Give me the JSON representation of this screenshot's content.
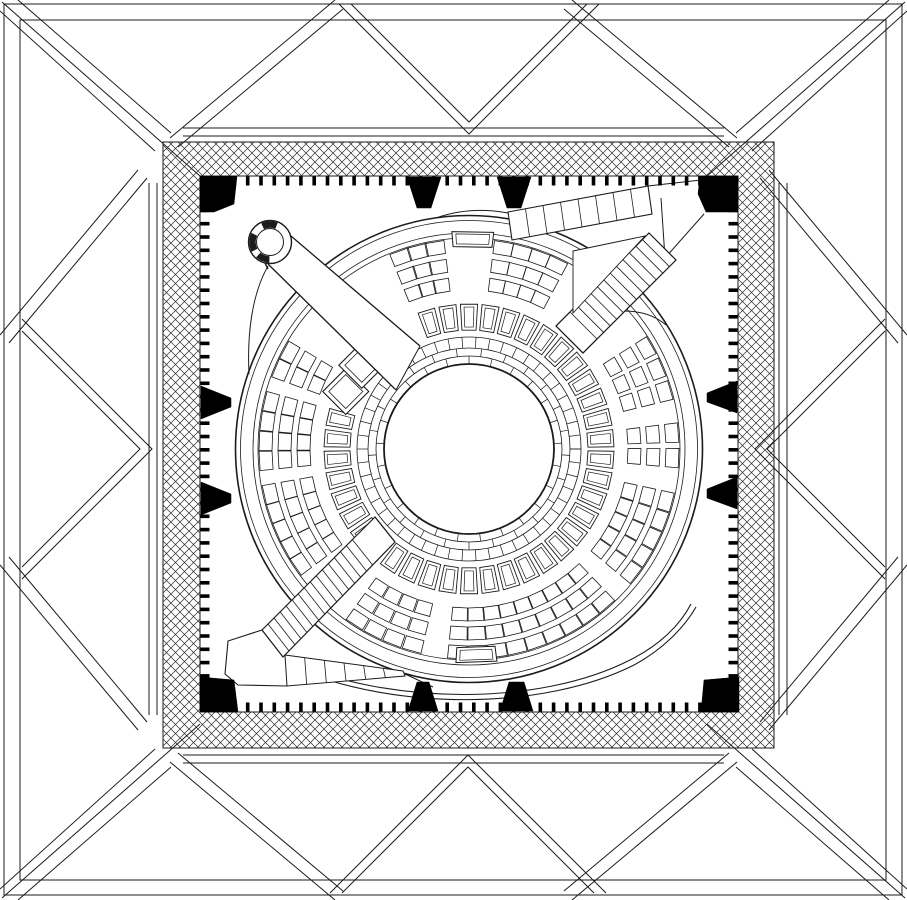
{
  "meta": {
    "aria": "Architectural floor plan drawing: circular assembly hall inside a square hatched frame with pyramidal roof panels"
  },
  "colors": {
    "ink": "#1b1b1b",
    "paper": "#ffffff",
    "solid": "#000000"
  },
  "canvas": {
    "w": 907,
    "h": 900
  },
  "outer": {
    "frames": [
      [
        4,
        4,
        898,
        891
      ],
      [
        20,
        20,
        866,
        860
      ]
    ],
    "side_lines": [
      [
        183,
        128,
        724,
        128
      ],
      [
        183,
        136,
        724,
        136
      ],
      [
        183,
        755,
        724,
        755
      ],
      [
        183,
        763,
        724,
        763
      ],
      [
        149,
        183,
        149,
        715
      ],
      [
        157,
        183,
        157,
        715
      ],
      [
        779,
        183,
        779,
        715
      ],
      [
        787,
        183,
        787,
        715
      ]
    ],
    "v_folds": [
      [
        [
          339,
          4
        ],
        [
          469,
          134
        ],
        [
          599,
          4
        ]
      ],
      [
        [
          351,
          4
        ],
        [
          469,
          122
        ],
        [
          587,
          4
        ]
      ],
      [
        [
          330,
          893
        ],
        [
          468,
          755
        ],
        [
          606,
          893
        ]
      ],
      [
        [
          342,
          893
        ],
        [
          468,
          767
        ],
        [
          594,
          893
        ]
      ],
      [
        [
          22,
          319
        ],
        [
          152,
          449
        ],
        [
          22,
          579
        ]
      ],
      [
        [
          22,
          331
        ],
        [
          140,
          449
        ],
        [
          22,
          567
        ]
      ],
      [
        [
          885,
          319
        ],
        [
          755,
          449
        ],
        [
          885,
          579
        ]
      ],
      [
        [
          885,
          331
        ],
        [
          767,
          449
        ],
        [
          885,
          567
        ]
      ]
    ],
    "corner_lines": [
      [
        2,
        2,
        200,
        176
      ],
      [
        18,
        0,
        171,
        133
      ],
      [
        0,
        11,
        155,
        151
      ],
      [
        170,
        138,
        335,
        0
      ],
      [
        178,
        147,
        343,
        9
      ],
      [
        138,
        170,
        0,
        335
      ],
      [
        147,
        178,
        9,
        343
      ]
    ]
  },
  "band": {
    "outer": [
      163,
      142,
      611,
      606
    ],
    "inner": [
      200,
      176,
      538,
      536
    ],
    "tile": 18
  },
  "ticks": {
    "len": 9,
    "thick": 3.6,
    "step": 13.3,
    "inset": 6
  },
  "black_pieces": {
    "corners": [
      [
        [
          200,
          176
        ],
        [
          237,
          176
        ],
        [
          234,
          204
        ],
        [
          214,
          212
        ],
        [
          200,
          212
        ]
      ],
      [
        [
          700,
          176
        ],
        [
          738,
          176
        ],
        [
          738,
          212
        ],
        [
          706,
          212
        ],
        [
          698,
          194
        ]
      ],
      [
        [
          200,
          677
        ],
        [
          234,
          680
        ],
        [
          238,
          712
        ],
        [
          200,
          712
        ]
      ],
      [
        [
          704,
          680
        ],
        [
          739,
          677
        ],
        [
          739,
          712
        ],
        [
          701,
          712
        ]
      ]
    ],
    "edge_wedges": [
      [
        [
          407,
          177
        ],
        [
          441,
          177
        ],
        [
          431,
          208
        ],
        [
          417,
          208
        ]
      ],
      [
        [
          497,
          177
        ],
        [
          531,
          177
        ],
        [
          521,
          208
        ],
        [
          507,
          208
        ]
      ],
      [
        [
          408,
          711
        ],
        [
          438,
          711
        ],
        [
          429,
          682
        ],
        [
          417,
          682
        ]
      ],
      [
        [
          500,
          711
        ],
        [
          533,
          711
        ],
        [
          524,
          682
        ],
        [
          509,
          682
        ]
      ],
      [
        [
          201,
          386
        ],
        [
          231,
          398
        ],
        [
          231,
          407
        ],
        [
          201,
          419
        ]
      ],
      [
        [
          201,
          482
        ],
        [
          231,
          494
        ],
        [
          231,
          503
        ],
        [
          201,
          515
        ]
      ],
      [
        [
          737,
          381
        ],
        [
          707,
          393
        ],
        [
          707,
          402
        ],
        [
          737,
          413
        ]
      ],
      [
        [
          737,
          477
        ],
        [
          707,
          489
        ],
        [
          707,
          498
        ],
        [
          737,
          509
        ]
      ]
    ]
  },
  "chamber": {
    "center": [
      469,
      449
    ],
    "circles": [
      {
        "r": 233.5,
        "w": 1.6
      },
      {
        "r": 228.5,
        "w": 0.8
      },
      {
        "r": 216,
        "w": 0.8
      },
      {
        "r": 211,
        "w": 0.8
      },
      {
        "r": 112,
        "w": 0.8
      },
      {
        "r": 101,
        "w": 0.8
      },
      {
        "r": 93,
        "w": 0.8
      },
      {
        "r": 85,
        "w": 1.8
      }
    ],
    "sweeps": [
      "M287,660 C390,706 540,706 630,660 C660,645 680,625 691,604",
      "M290,666 C395,712 545,710 634,665 C662,650 684,628 696,607"
    ],
    "dividers": [
      {
        "r0": 101,
        "r1": 112,
        "step": 7.2,
        "off": 0
      },
      {
        "r0": 93,
        "r1": 101,
        "step": 14.4,
        "off": 3.6
      },
      {
        "r0": 85,
        "r1": 93,
        "step": 14.4,
        "off": 10.8
      }
    ],
    "ring": {
      "r0": 119,
      "r1": 145,
      "count": 42,
      "width": 6.8,
      "inset": 3,
      "gap": [
        199,
        251
      ]
    },
    "diamonds": [
      {
        "a": 205,
        "r": 136,
        "s": 23,
        "inset": 6
      },
      {
        "a": 218,
        "r": 136,
        "s": 23,
        "inset": 6
      }
    ],
    "rows": [
      [
        159,
        172
      ],
      [
        178,
        191
      ],
      [
        197,
        210
      ]
    ],
    "blocks": [
      [
        352,
        6
      ],
      [
        12,
        40
      ],
      [
        46,
        96
      ],
      [
        103,
        126
      ],
      [
        143,
        170
      ],
      [
        174,
        196
      ],
      [
        200,
        211
      ],
      [
        248,
        263
      ],
      [
        277,
        298
      ],
      [
        327,
        347
      ]
    ],
    "pitch": 5.8,
    "box_w": 5.3,
    "podiums": [
      {
        "a0": 265.5,
        "a1": 276.5,
        "r0": 203,
        "r1": 218
      },
      {
        "a0": 82.5,
        "a1": 93.5,
        "r0": 199,
        "r1": 214
      }
    ]
  },
  "circulation": {
    "merges": [
      "M268,266 C252,294 247,334 249,374",
      "M594,316 Q640,303 666,325",
      "M508,213 Q470,206 436,218"
    ],
    "nw_corridor": {
      "fill": [
        [
          291,
          236
        ],
        [
          420,
          346
        ],
        [
          396,
          390
        ],
        [
          268,
          264
        ]
      ],
      "edges": [
        [
          291,
          236,
          420,
          346
        ],
        [
          268,
          264,
          396,
          390
        ]
      ],
      "cap": [
        420,
        346,
        396,
        390
      ]
    },
    "spiral": {
      "c": [
        270,
        242
      ],
      "r_out": 21.5,
      "r_in": 13.5,
      "thick_arcs": [
        [
          245,
          292
        ],
        [
          152,
          206
        ],
        [
          92,
          132
        ]
      ],
      "tick": [
        265,
        263,
        268,
        269
      ]
    },
    "ne": {
      "ramp_quad": [
        [
          512,
          240
        ],
        [
          652,
          214
        ],
        [
          648,
          186
        ],
        [
          508,
          212
        ]
      ],
      "ramp_divs": 8,
      "conn_lines": [
        [
          648,
          186,
          701,
          180
        ],
        [
          665,
          258,
          704,
          214
        ],
        [
          661,
          198,
          665,
          258
        ]
      ],
      "stair_fill": [
        [
          649,
          233
        ],
        [
          676,
          260
        ],
        [
          583,
          353
        ],
        [
          556,
          326
        ]
      ],
      "stair_e1": [
        [
          649,
          233
        ],
        [
          570,
          312
        ]
      ],
      "stair_e2": [
        [
          676,
          260
        ],
        [
          597,
          339
        ]
      ],
      "treads": 12,
      "ext": [
        [
          570,
          312,
          556,
          326
        ],
        [
          597,
          339,
          583,
          353
        ]
      ],
      "cap": [
        556,
        326,
        583,
        353
      ],
      "wedge": [
        [
          573,
          251
        ],
        [
          645,
          236
        ],
        [
          573,
          313
        ]
      ]
    },
    "sw": {
      "stair_fill": [
        [
          375,
          517
        ],
        [
          395,
          542
        ],
        [
          283,
          657
        ],
        [
          262,
          630
        ]
      ],
      "stair_e1": [
        [
          375,
          517
        ],
        [
          262,
          630
        ]
      ],
      "stair_e2": [
        [
          395,
          542
        ],
        [
          283,
          657
        ]
      ],
      "treads": 15,
      "tread_from": 0.2,
      "cap": [
        375,
        517,
        395,
        542
      ],
      "wedge_quad": [
        [
          285,
          655
        ],
        [
          403,
          671
        ],
        [
          405,
          676
        ],
        [
          287,
          686
        ]
      ],
      "wedge_divs": 6,
      "ext_line": [
        405,
        674,
        433,
        687
      ],
      "outline_fill": [
        [
          262,
          630
        ],
        [
          228,
          641
        ],
        [
          225,
          674
        ],
        [
          238,
          685
        ],
        [
          287,
          686
        ],
        [
          285,
          655
        ]
      ],
      "outline": "M262,630 L228,641 L225,674 L238,685 L287,686"
    }
  }
}
